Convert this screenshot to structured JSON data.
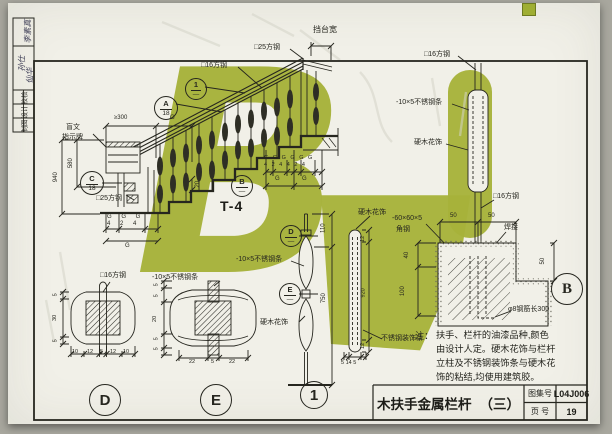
{
  "watermark": {
    "letter": "B"
  },
  "stamp": {
    "sig1": "李素真",
    "sig2": "孙仕",
    "sig3": "仙华",
    "labels": [
      "校核",
      "设计",
      "制图"
    ]
  },
  "main": {
    "platform": "挡台宽",
    "sq25a": "□25方钢",
    "sq16": "□16方钢",
    "braille1": "盲文",
    "braille2": "指示牌",
    "sq25b": "□25方钢",
    "t4": "T-4",
    "ge300": "≥300",
    "g1": "G",
    "d580": "580",
    "d940": "940",
    "d20": "20",
    "grp1a": "G G G",
    "grp1b": "4 2 4",
    "gL": "G",
    "grp2a": "G G G G G G",
    "grp2b": "4 2 4 4 2 4",
    "gR1": "G",
    "gR2": "G"
  },
  "marks": {
    "a_t": "A",
    "a_b": "18",
    "one_t": "1",
    "one_b": "—",
    "c_t": "C",
    "c_b": "18",
    "bm_t": "B",
    "bm_b": "—",
    "dm_t": "D",
    "dm_b": "—",
    "em_t": "E",
    "em_b": "—",
    "d_title": "D",
    "e_title": "E",
    "one_title": "1",
    "b_title": "B"
  },
  "detailD": {
    "label": "□16方钢",
    "dims_h": [
      "10",
      "12",
      "5",
      "12",
      "10"
    ],
    "dims_v": [
      "5",
      "30",
      "5"
    ]
  },
  "detailE": {
    "label": "-10×5不锈钢条",
    "dims_h": [
      "22",
      "5",
      "22"
    ],
    "dims_v": [
      "5",
      "5",
      "20",
      "5",
      "5"
    ]
  },
  "detail1": {
    "steel": "-10×5不锈钢条",
    "wood1": "硬木花饰",
    "wood2": "硬木花饰",
    "trim": "不锈钢装饰条",
    "d110": "110",
    "d750": "750",
    "d12a": "12",
    "d920": "920",
    "d12b": "12",
    "dbase": "5 14 5"
  },
  "detailB": {
    "sq16a": "□16方钢",
    "steel": "-10×5不锈钢条",
    "wood": "硬木花饰",
    "sq16b": "□16方钢",
    "angle1": "-60×60×5",
    "angle2": "角钢",
    "weld": "焊接",
    "d50a": "50",
    "d50b": "50",
    "d40": "40",
    "d100": "100",
    "d50c": "50",
    "rebar": "φ8钢筋长300"
  },
  "notes": {
    "tag": "注：",
    "lines": [
      "扶手、栏杆的油漆品种,颜色",
      "由设计人定。硬木花饰与栏杆",
      "立柱及不锈钢装饰条与硬木花",
      "饰的粘结,均使用建筑胶。"
    ]
  },
  "titleblock": {
    "title": "木扶手金属栏杆",
    "sub": "（三）",
    "atlas_label": "图集号",
    "atlas_no": "L04J006",
    "page_label": "页 号",
    "page_no": "19"
  }
}
